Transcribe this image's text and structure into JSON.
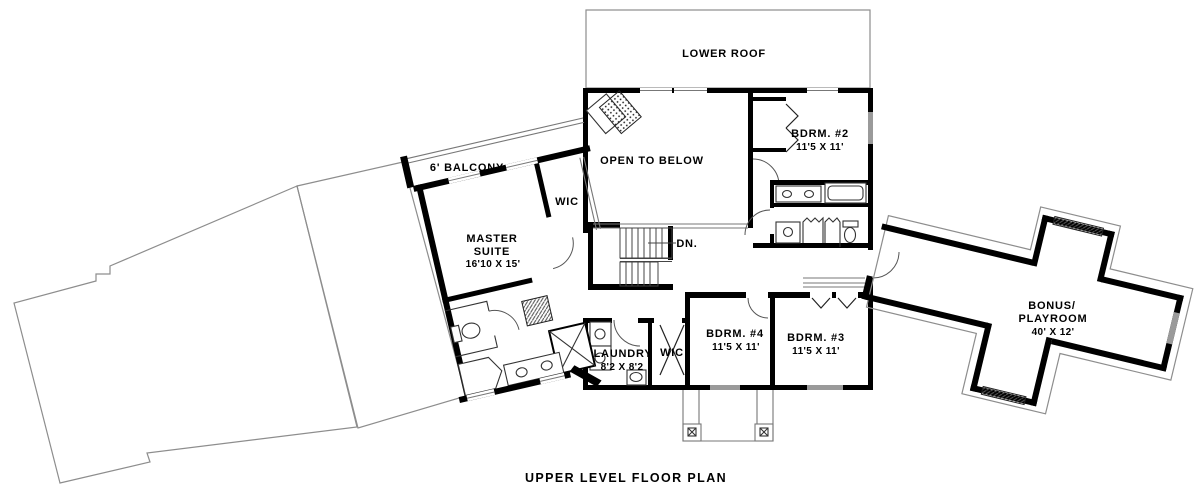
{
  "title": "UPPER LEVEL FLOOR PLAN",
  "colors": {
    "wall": "#000000",
    "thin_outline": "#8d8d8d",
    "window_fill": "#9a9a9a",
    "paper": "#ffffff",
    "text": "#000000"
  },
  "rooms": {
    "lower_roof": {
      "label": "LOWER ROOF"
    },
    "open_to_below": {
      "label": "OPEN TO BELOW"
    },
    "balcony": {
      "label": "6' BALCONY"
    },
    "master_suite": {
      "line1": "MASTER",
      "line2": "SUITE",
      "dims": "16'10 X 15'"
    },
    "wic_master": {
      "label": "WIC"
    },
    "bdrm2": {
      "label": "BDRM. #2",
      "dims": "11'5 X 11'"
    },
    "bdrm4": {
      "label": "BDRM. #4",
      "dims": "11'5 X 11'"
    },
    "bdrm3": {
      "label": "BDRM. #3",
      "dims": "11'5 X 11'"
    },
    "laundry": {
      "label": "LAUNDRY",
      "dims": "8'2 X 8'2"
    },
    "wic_hall": {
      "label": "WIC"
    },
    "bonus": {
      "line1": "BONUS/",
      "line2": "PLAYROOM",
      "dims": "40' X 12'"
    },
    "stairs": {
      "label": "DN."
    }
  }
}
